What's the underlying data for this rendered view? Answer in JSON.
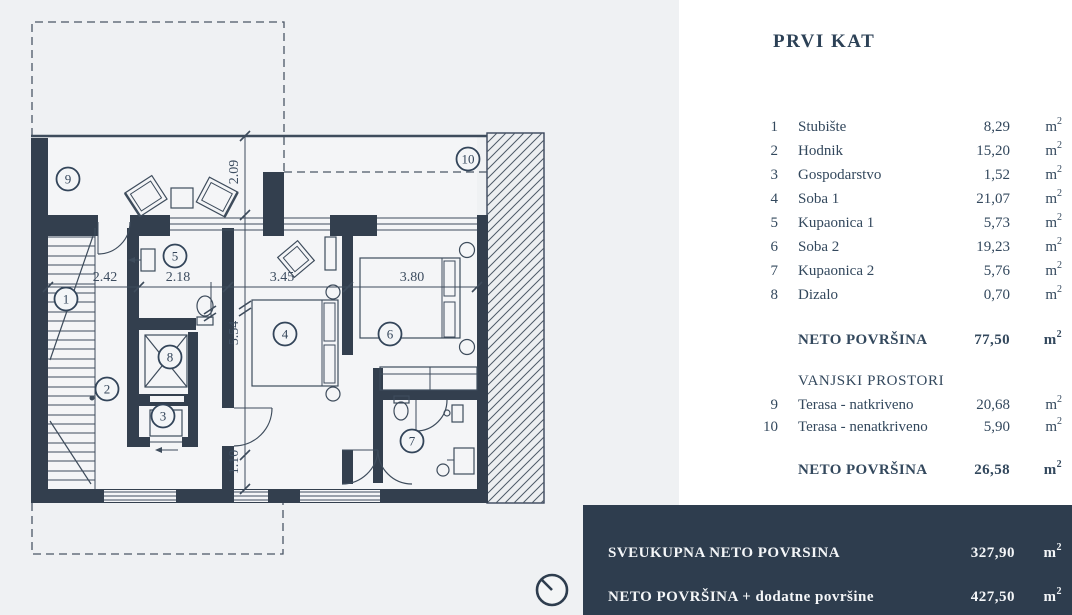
{
  "title": "PRVI KAT",
  "unit": {
    "base": "m",
    "sup": "2"
  },
  "table": {
    "rows": [
      {
        "num": "1",
        "label": "Stubište",
        "value": "8,29"
      },
      {
        "num": "2",
        "label": "Hodnik",
        "value": "15,20"
      },
      {
        "num": "3",
        "label": "Gospodarstvo",
        "value": "1,52"
      },
      {
        "num": "4",
        "label": "Soba 1",
        "value": "21,07"
      },
      {
        "num": "5",
        "label": "Kupaonica 1",
        "value": "5,73"
      },
      {
        "num": "6",
        "label": "Soba 2",
        "value": "19,23"
      },
      {
        "num": "7",
        "label": "Kupaonica 2",
        "value": "5,76"
      },
      {
        "num": "8",
        "label": "Dizalo",
        "value": "0,70"
      }
    ],
    "neto_unutarnje": {
      "label": "NETO POVRŠINA",
      "value": "77,50"
    },
    "vanjski_naslov": "VANJSKI PROSTORI",
    "vanjski_rows": [
      {
        "num": "9",
        "label": "Terasa - natkriveno",
        "value": "20,68"
      },
      {
        "num": "10",
        "label": "Terasa - nenatkriveno",
        "value": "5,90"
      }
    ],
    "neto_vanjsko": {
      "label": "NETO POVRŠINA",
      "value": "26,58"
    }
  },
  "summary_bar": {
    "rows": [
      {
        "label": "SVEUKUPNA NETO POVRSINA",
        "value": "327,90"
      },
      {
        "label": "NETO POVRŠINA + dodatne površine",
        "value": "427,50"
      }
    ]
  },
  "plan": {
    "room_numbers": [
      "1",
      "2",
      "3",
      "4",
      "5",
      "6",
      "7",
      "8",
      "9",
      "10"
    ],
    "dims": {
      "w1": "2.42",
      "w2": "2.18",
      "w3": "3.45",
      "w4": "3.80",
      "h1": "2.09",
      "h2": "5.54",
      "h3": "1.10"
    }
  },
  "colors": {
    "wall": "#333f4e",
    "canvas_bg": "#eff1f3",
    "panel_bg": "#ffffff",
    "bar_bg": "#2e3d4e",
    "text": "#33485d",
    "bar_text": "#f4f6f8"
  }
}
